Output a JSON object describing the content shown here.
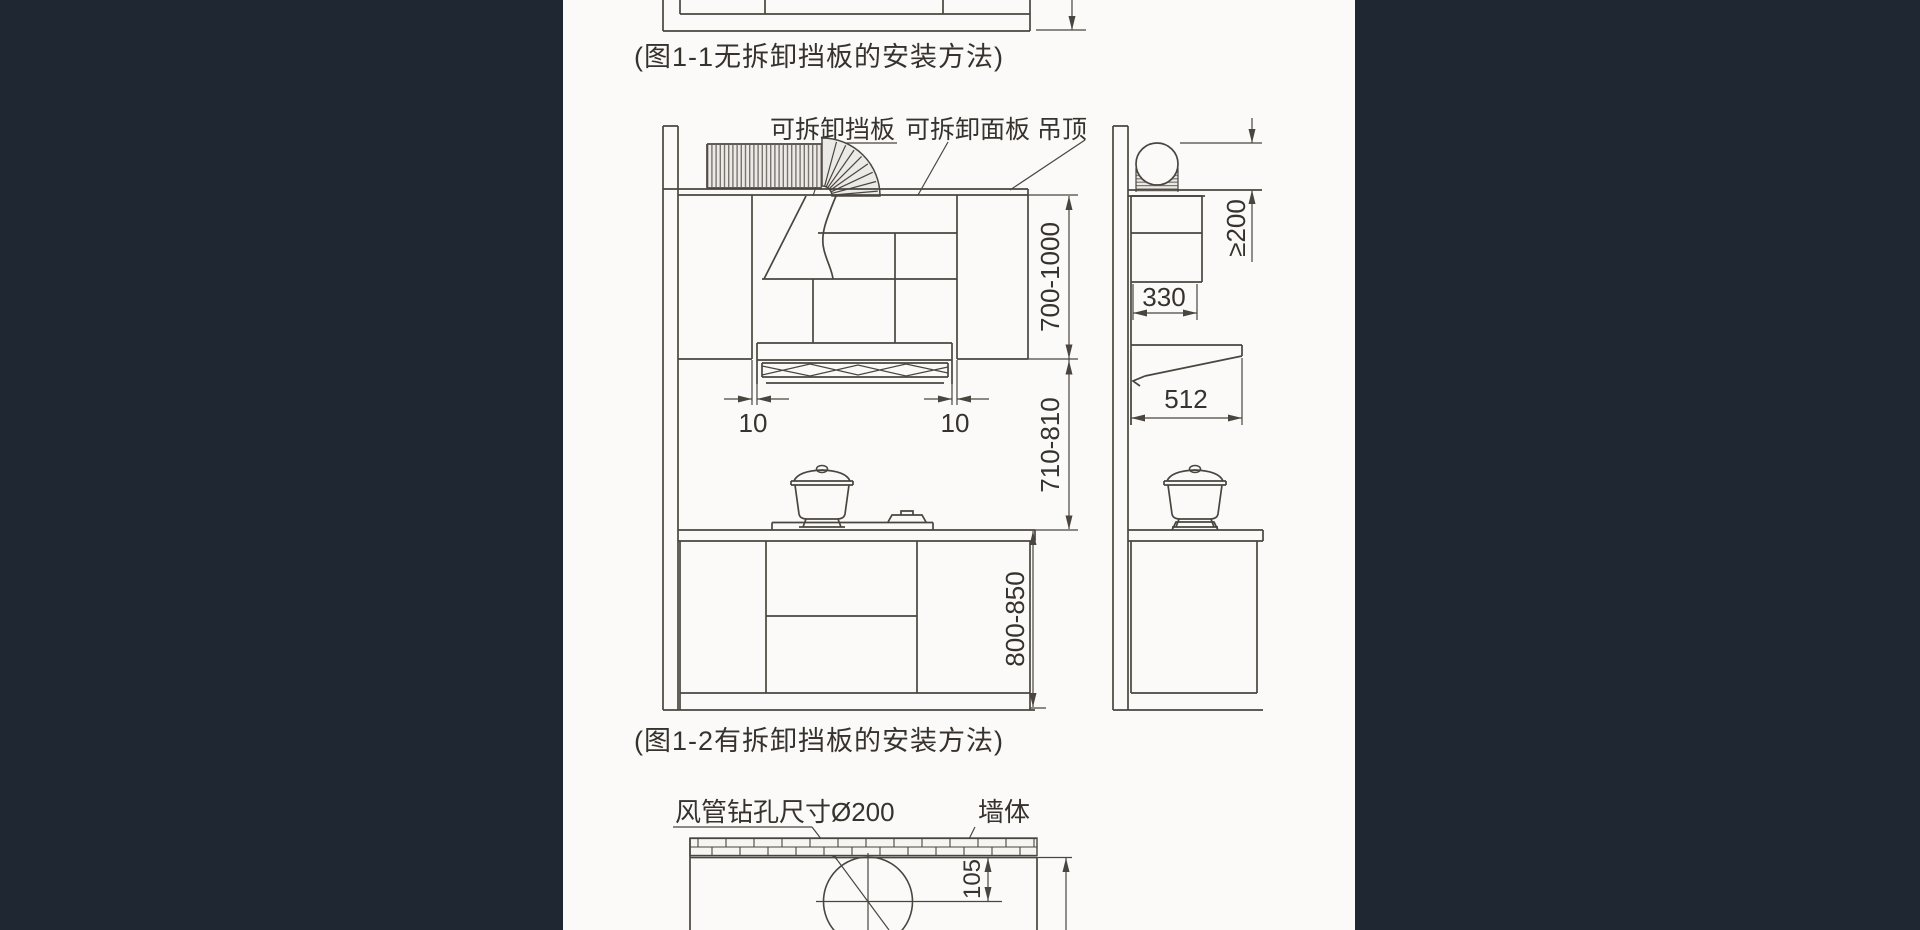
{
  "canvas": {
    "background_color": "#1f2733",
    "paper_color": "#fbfaf8",
    "line_color": "#4a453f",
    "text_color": "#37322e"
  },
  "figure1_1": {
    "caption": "(图1-1无拆卸挡板的安装方法)"
  },
  "figure1_2": {
    "caption": "(图1-2有拆卸挡板的安装方法)",
    "label_removable_baffle": "可拆卸挡板",
    "label_removable_panel": "可拆卸面板",
    "label_ceiling": "吊顶",
    "dim_gap_left": "10",
    "dim_gap_right": "10",
    "dim_ceiling_to_cabinet_bottom": "700-1000",
    "dim_cabinet_bottom_to_counter": "710-810",
    "dim_counter_height": "800-850",
    "dim_hood_depth": "330",
    "dim_canopy_depth": "512",
    "dim_duct_clearance": "≥200"
  },
  "figure_drill": {
    "label_duct_hole": "风管钻孔尺寸Ø200",
    "label_wall": "墙体",
    "dim_center_offset": "105",
    "dim_partial": "2"
  }
}
